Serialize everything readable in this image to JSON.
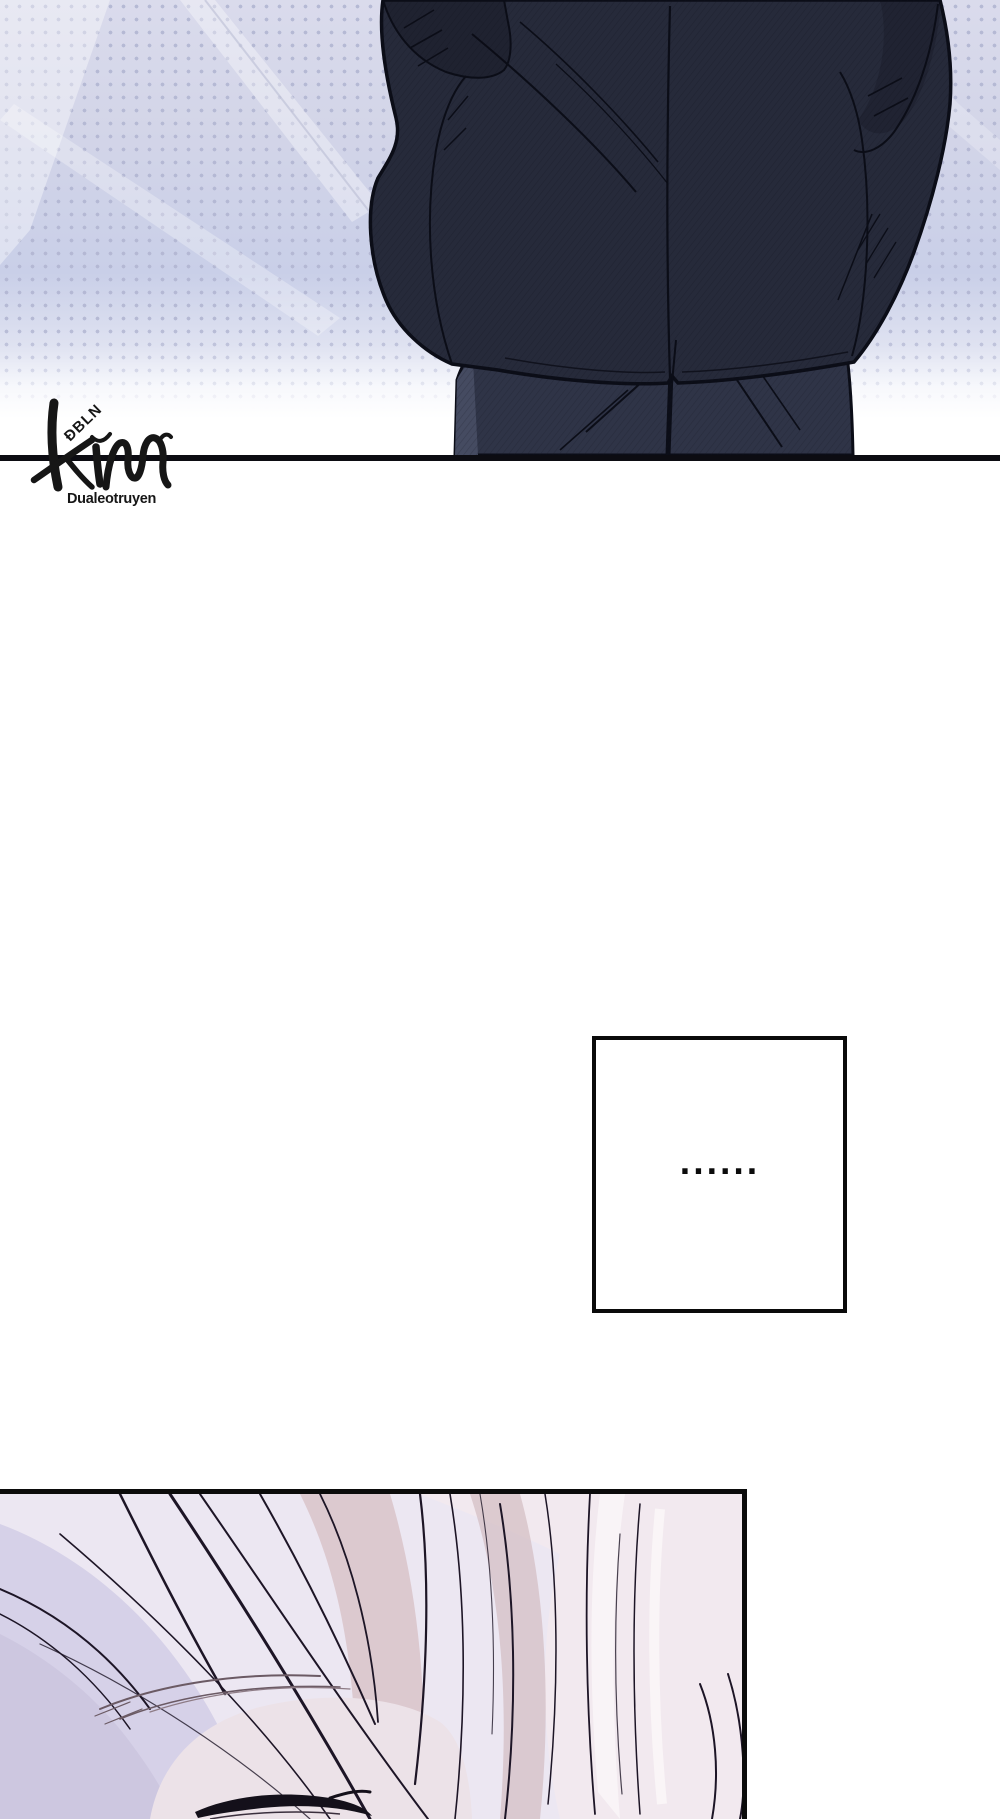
{
  "page": {
    "kind": "manhwa webtoon page",
    "background": "#ffffff"
  },
  "top_panel": {
    "description": "Back view of a man in a dark navy suit standing against a lavender halftone background, cropped at the hips by the panel border",
    "bg_top": "#d9daeb",
    "bg_mid": "#c9cfe8",
    "halftone_dot": "#b2b6d2",
    "suit_color": "#262a3a",
    "trouser_color": "#2f3447",
    "outline_color": "#0b0d17",
    "divider_color": "#0c0c12"
  },
  "watermark": {
    "brand_script": "Kim",
    "overlay_text": "ĐBLN",
    "site_text": "Dualeotruyen",
    "color": "#161616"
  },
  "speech_box": {
    "text": "......",
    "border_color": "#0a0a0a",
    "fill_color": "#ffffff"
  },
  "bottom_panel": {
    "description": "Close-up of a sleeping face with pale pink hair, closed eye with dark lashes, lavender shadows on the left",
    "base_color": "#ece7f2",
    "shadow_color": "#d6d1e8",
    "hair_pink": "#f2e9ef",
    "hair_rose": "#d9c3c9",
    "line_color": "#1d1526",
    "border_color": "#0b0b0b"
  }
}
